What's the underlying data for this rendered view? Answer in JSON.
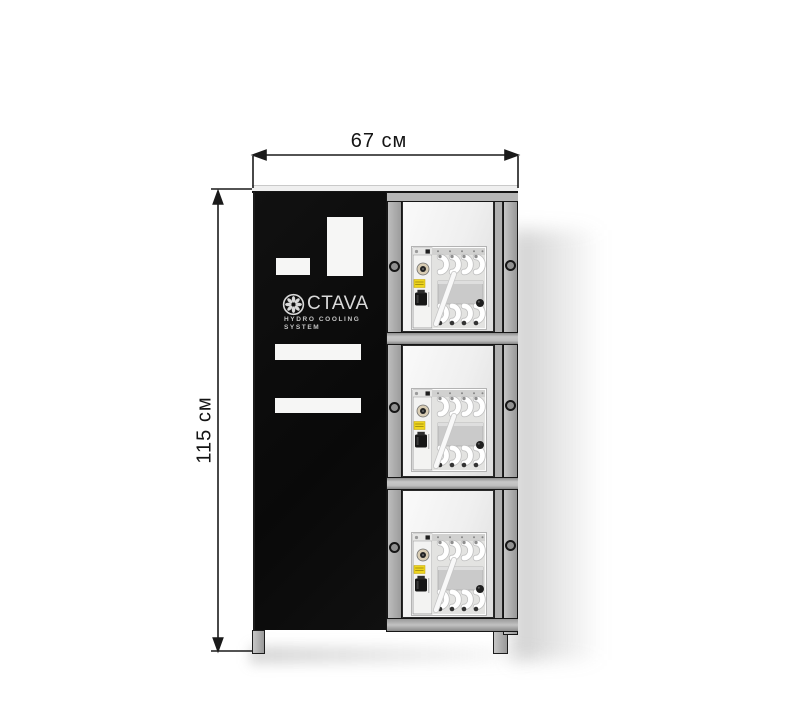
{
  "figure": {
    "width_label": "67 см",
    "height_label": "115 см"
  },
  "branding": {
    "logo_text": "CTAVA",
    "logo_full_name": "OCTAVA",
    "tagline_line1": "HYDRO  COOLING",
    "tagline_line2": "SYSTEM"
  },
  "cabinet": {
    "compartment_count": 3,
    "colors": {
      "door": "#0c0c0c",
      "frame": "#a6a6a6",
      "dimension_lines": "#1a1a1a",
      "equipment_label_accent": "#eed51e"
    }
  }
}
